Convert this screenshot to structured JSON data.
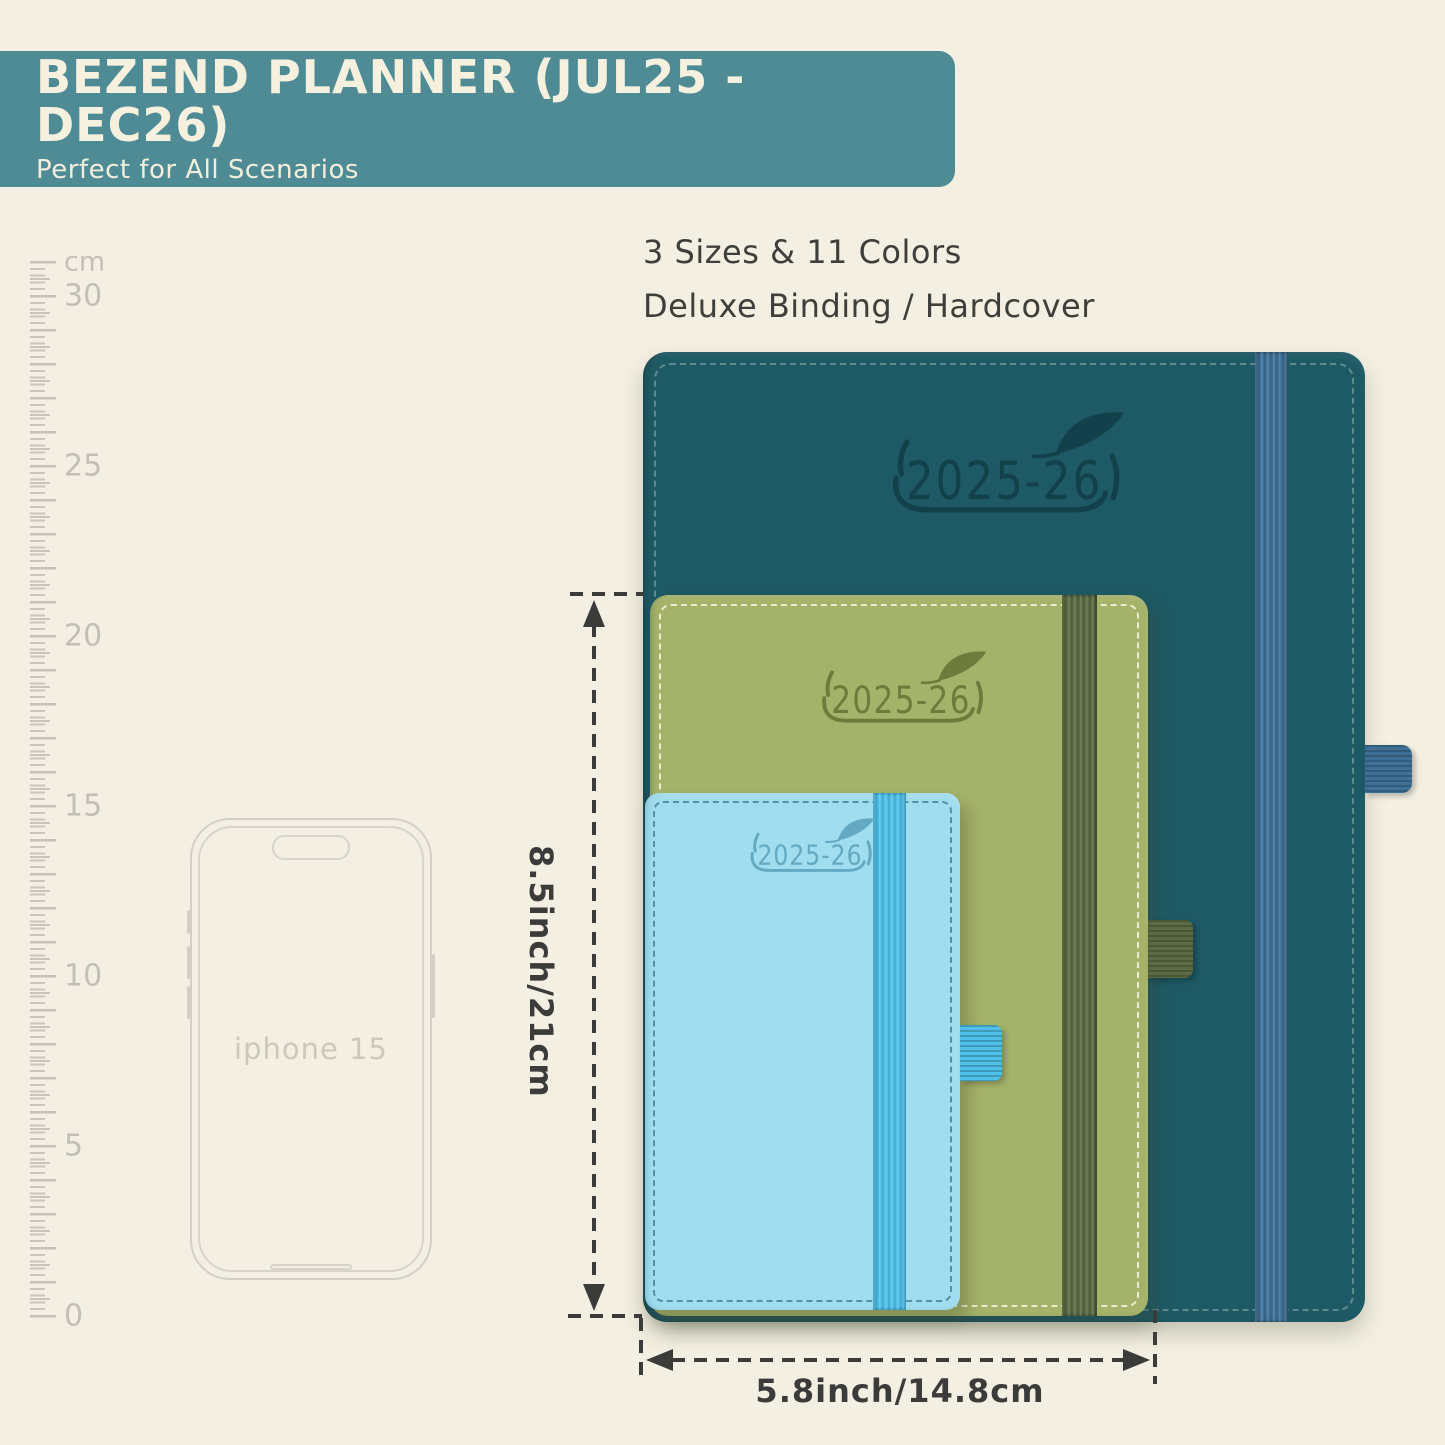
{
  "banner": {
    "title": "BEZEND PLANNER (JUL25 - DEC26)",
    "subtitle": "Perfect for All Scenarios",
    "bg_color": "#4e8b95",
    "text_color": "#f6f1df"
  },
  "headline": {
    "line1": "3 Sizes & 11 Colors",
    "line2": "Deluxe Binding / Hardcover"
  },
  "ruler": {
    "unit_label": "cm",
    "labels": [
      "30",
      "25",
      "20",
      "15",
      "10",
      "5",
      "0"
    ]
  },
  "phone": {
    "label": "iphone 15"
  },
  "planners": [
    {
      "name": "large-teal-planner",
      "year_label": "2025-26",
      "cover_color": "#1e5a65",
      "band_color": "#3f7097",
      "emboss_color": "#12414c"
    },
    {
      "name": "medium-green-planner",
      "year_label": "2025-26",
      "cover_color": "#a5b36a",
      "band_color": "#5c6b43",
      "emboss_color": "#6d7c3b"
    },
    {
      "name": "small-blue-planner",
      "year_label": "2025-26",
      "cover_color": "#a0ddee",
      "band_color": "#4fc0e8",
      "emboss_color": "#63a9c2"
    }
  ],
  "dimensions": {
    "height_label": "8.5inch/21cm",
    "width_label": "5.8inch/14.8cm"
  }
}
